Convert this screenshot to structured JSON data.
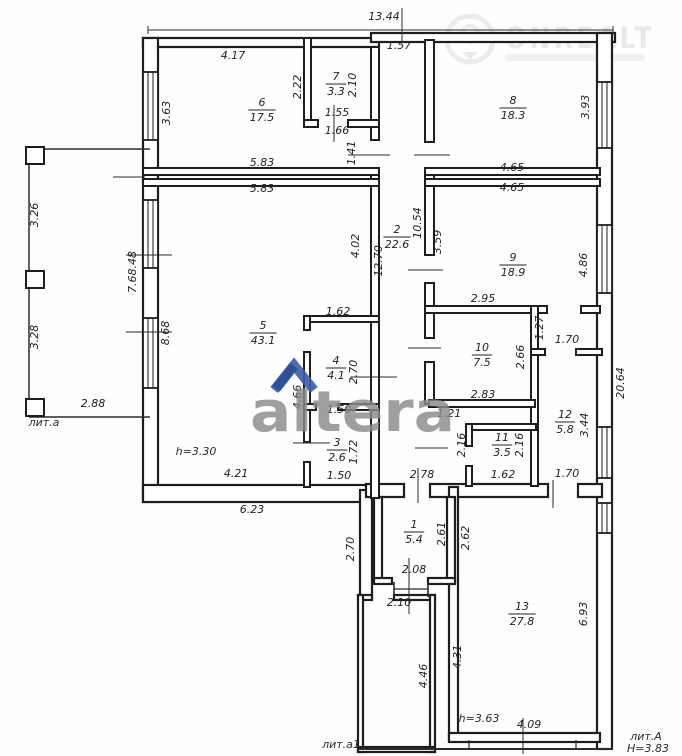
{
  "watermarks": {
    "altera": {
      "text": "altera",
      "chevron_color": "#3d5ca6",
      "text_color": "#8b8b8b"
    },
    "onrealt": {
      "text": "ONREALT",
      "color": "#d9d9d9"
    }
  },
  "plan": {
    "rooms": [
      {
        "number": "1",
        "area": "5.4",
        "x": 414,
        "y": 531
      },
      {
        "number": "2",
        "area": "22.6",
        "x": 397,
        "y": 236
      },
      {
        "number": "3",
        "area": "2.6",
        "x": 337,
        "y": 449
      },
      {
        "number": "4",
        "area": "4.1",
        "x": 336,
        "y": 367
      },
      {
        "number": "5",
        "area": "43.1",
        "x": 263,
        "y": 332
      },
      {
        "number": "6",
        "area": "17.5",
        "x": 262,
        "y": 109
      },
      {
        "number": "7",
        "area": "3.3",
        "x": 336,
        "y": 83
      },
      {
        "number": "8",
        "area": "18.3",
        "x": 513,
        "y": 107
      },
      {
        "number": "9",
        "area": "18.9",
        "x": 513,
        "y": 264
      },
      {
        "number": "10",
        "area": "7.5",
        "x": 482,
        "y": 354
      },
      {
        "number": "11",
        "area": "3.5",
        "x": 502,
        "y": 444
      },
      {
        "number": "12",
        "area": "5.8",
        "x": 565,
        "y": 421
      },
      {
        "number": "13",
        "area": "27.8",
        "x": 522,
        "y": 613
      }
    ],
    "dimensions": [
      {
        "v": "13.44",
        "x": 384,
        "y": 20,
        "r": 0
      },
      {
        "v": "1.57",
        "x": 399,
        "y": 49,
        "r": 0
      },
      {
        "v": "4.17",
        "x": 233,
        "y": 59,
        "r": 0
      },
      {
        "v": "2.22",
        "x": 301,
        "y": 87,
        "r": -90
      },
      {
        "v": "2.10",
        "x": 356,
        "y": 85,
        "r": -90
      },
      {
        "v": "1.55",
        "x": 337,
        "y": 116,
        "r": 0
      },
      {
        "v": "1.66",
        "x": 337,
        "y": 134,
        "r": 0
      },
      {
        "v": "1.41",
        "x": 355,
        "y": 153,
        "r": -90
      },
      {
        "v": "3.63",
        "x": 170,
        "y": 113,
        "r": -90
      },
      {
        "v": "5.83",
        "x": 262,
        "y": 166,
        "r": 0
      },
      {
        "v": "5.83",
        "x": 262,
        "y": 192,
        "r": 0
      },
      {
        "v": "3.93",
        "x": 589,
        "y": 107,
        "r": -90
      },
      {
        "v": "4.65",
        "x": 512,
        "y": 171,
        "r": 0
      },
      {
        "v": "4.65",
        "x": 512,
        "y": 191,
        "r": 0
      },
      {
        "v": "3.59",
        "x": 441,
        "y": 242,
        "r": -90
      },
      {
        "v": "4.86",
        "x": 587,
        "y": 265,
        "r": -90
      },
      {
        "v": "2.95",
        "x": 483,
        "y": 302,
        "r": 0
      },
      {
        "v": "12.70",
        "x": 382,
        "y": 261,
        "r": -90
      },
      {
        "v": "10.54",
        "x": 421,
        "y": 223,
        "r": -90
      },
      {
        "v": "4.02",
        "x": 359,
        "y": 246,
        "r": -90
      },
      {
        "v": "7.68.48",
        "x": 136,
        "y": 272,
        "r": -90
      },
      {
        "v": "8.68",
        "x": 169,
        "y": 333,
        "r": -90
      },
      {
        "v": "1.62",
        "x": 338,
        "y": 315,
        "r": 0
      },
      {
        "v": "4.21",
        "x": 236,
        "y": 477,
        "r": 0
      },
      {
        "v": "2.70",
        "x": 357,
        "y": 372,
        "r": -90
      },
      {
        "v": "4.66",
        "x": 301,
        "y": 397,
        "r": -90
      },
      {
        "v": "1.50",
        "x": 339,
        "y": 413,
        "r": 0
      },
      {
        "v": "1.72",
        "x": 357,
        "y": 452,
        "r": -90
      },
      {
        "v": "1.50",
        "x": 339,
        "y": 479,
        "r": 0
      },
      {
        "v": "2.66",
        "x": 524,
        "y": 357,
        "r": -90
      },
      {
        "v": "2.83",
        "x": 483,
        "y": 398,
        "r": 0
      },
      {
        "v": "1.27",
        "x": 543,
        "y": 328,
        "r": -90
      },
      {
        "v": "1.70",
        "x": 567,
        "y": 343,
        "r": 0
      },
      {
        "v": "1.21",
        "x": 449,
        "y": 417,
        "r": 0
      },
      {
        "v": "2.16",
        "x": 465,
        "y": 445,
        "r": -90
      },
      {
        "v": "2.16",
        "x": 523,
        "y": 445,
        "r": -90
      },
      {
        "v": "1.62",
        "x": 503,
        "y": 478,
        "r": 0
      },
      {
        "v": "3.44",
        "x": 588,
        "y": 425,
        "r": -90
      },
      {
        "v": "1.70",
        "x": 567,
        "y": 477,
        "r": 0
      },
      {
        "v": "20.64",
        "x": 624,
        "y": 383,
        "r": -90
      },
      {
        "v": "6.23",
        "x": 252,
        "y": 513,
        "r": 0
      },
      {
        "v": "2.70",
        "x": 354,
        "y": 549,
        "r": -90
      },
      {
        "v": "2.78",
        "x": 422,
        "y": 478,
        "r": 0
      },
      {
        "v": "2.61",
        "x": 445,
        "y": 534,
        "r": -90
      },
      {
        "v": "2.62",
        "x": 469,
        "y": 538,
        "r": -90
      },
      {
        "v": "2.08",
        "x": 414,
        "y": 573,
        "r": 0
      },
      {
        "v": "2.10",
        "x": 399,
        "y": 606,
        "r": 0
      },
      {
        "v": "4.46",
        "x": 427,
        "y": 676,
        "r": -90
      },
      {
        "v": "6.93",
        "x": 587,
        "y": 614,
        "r": -90
      },
      {
        "v": "4.31",
        "x": 461,
        "y": 657,
        "r": -90
      },
      {
        "v": "4.09",
        "x": 529,
        "y": 728,
        "r": 0
      },
      {
        "v": "3.26",
        "x": 38,
        "y": 215,
        "r": -90
      },
      {
        "v": "3.28",
        "x": 38,
        "y": 337,
        "r": -90
      },
      {
        "v": "2.88",
        "x": 93,
        "y": 407,
        "r": 0
      }
    ],
    "notes": [
      {
        "text": "h=3.30",
        "x": 196,
        "y": 455
      },
      {
        "text": "h=3.63",
        "x": 479,
        "y": 722
      }
    ],
    "building_labels": [
      {
        "text": "лит.а",
        "x": 44,
        "y": 426
      },
      {
        "text": "лит.а1",
        "x": 341,
        "y": 748
      },
      {
        "text": "лит.А",
        "x": 646,
        "y": 740
      },
      {
        "text": "Н=3.83",
        "x": 648,
        "y": 752
      }
    ]
  }
}
